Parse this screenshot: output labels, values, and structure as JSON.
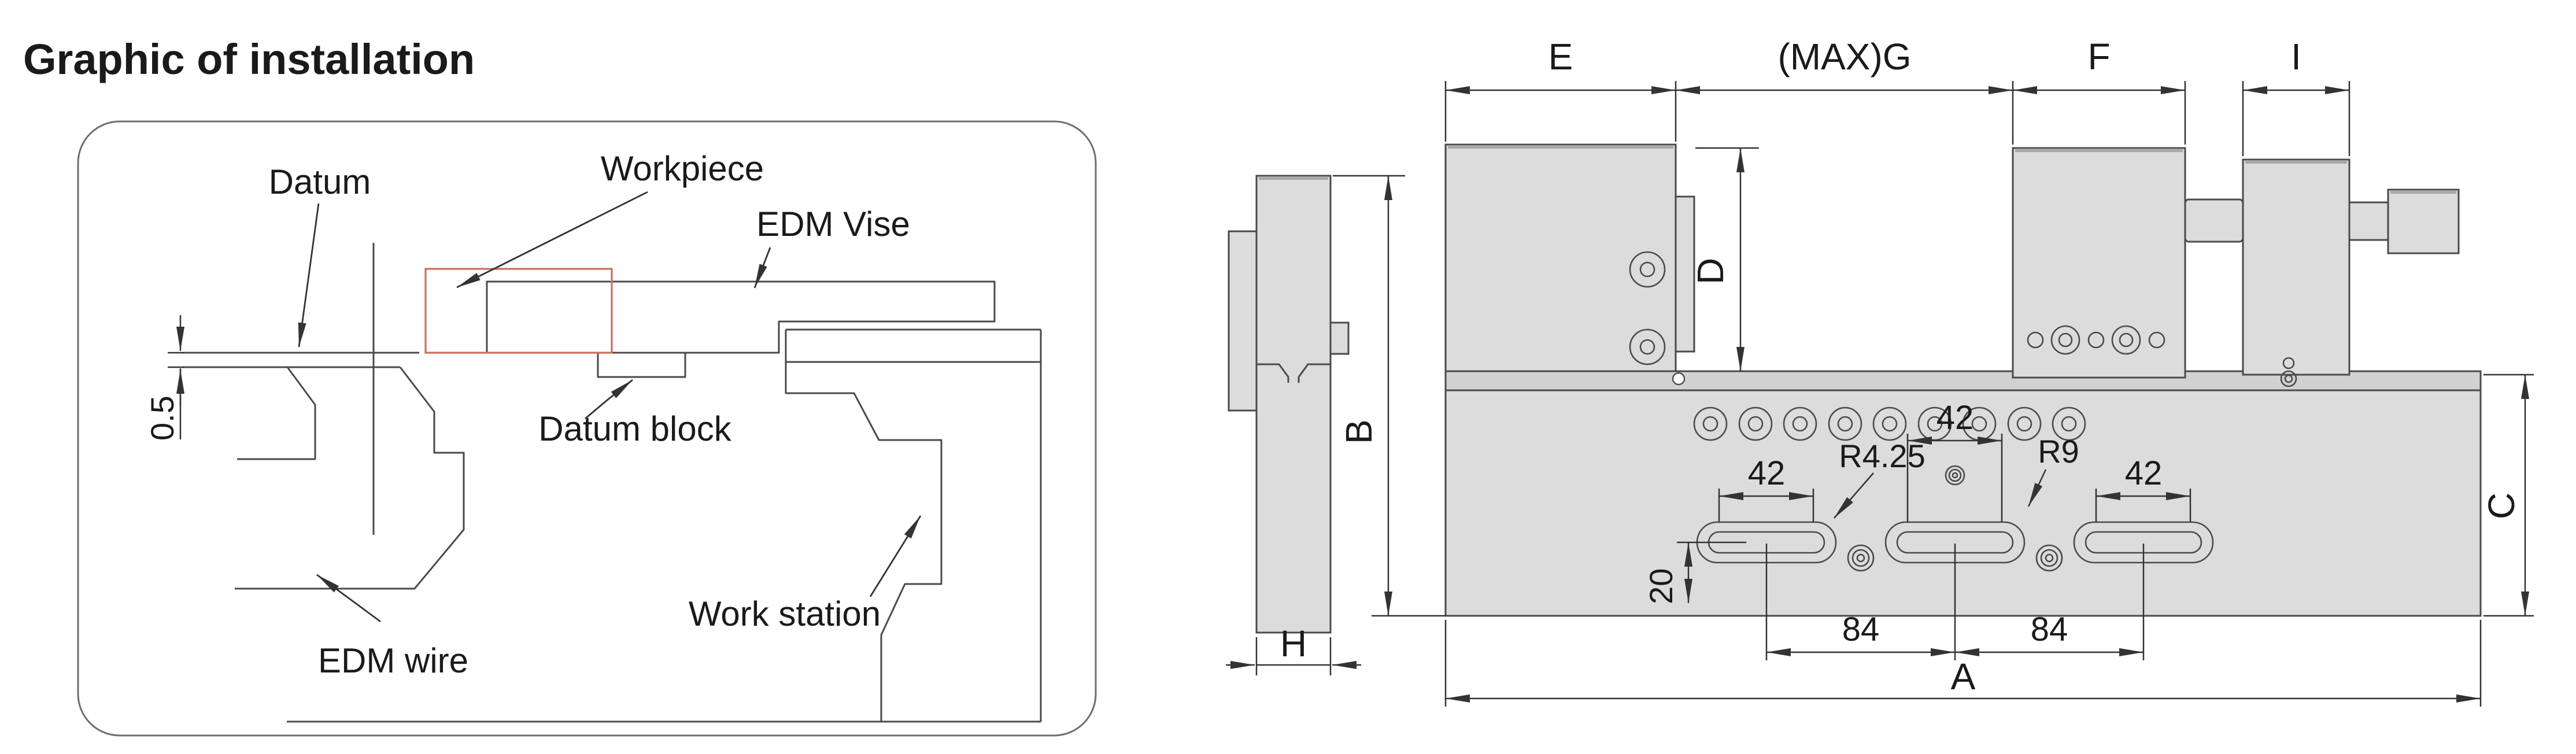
{
  "title": "Graphic of installation",
  "installation_diagram": {
    "labels": {
      "datum": "Datum",
      "workpiece": "Workpiece",
      "edm_vise": "EDM Vise",
      "datum_block": "Datum block",
      "edm_wire": "EDM wire",
      "work_station": "Work station"
    },
    "dimensions": {
      "datum_offset": "0.5"
    }
  },
  "technical_drawing": {
    "dimension_labels": {
      "overall_width": "A",
      "overall_height": "B",
      "base_height": "C",
      "jaw_height": "D",
      "fixed_jaw_width": "E",
      "max_opening": "(MAX)G",
      "movable_jaw_width": "F",
      "clamp_block_width": "I",
      "side_thickness": "H"
    },
    "measurements": {
      "slot_length": "42",
      "slot_spacing": "84",
      "slot_inner_radius": "R4.25",
      "slot_outer_radius": "R9",
      "slot_edge_offset": "20"
    }
  },
  "colors": {
    "part_fill": "#dcdcdc",
    "rail_fill": "#d2d2d2",
    "outline": "#4a4a4a",
    "dimension_line": "#333333",
    "workpiece_outline": "#cc6e62",
    "text": "#1a1a1a"
  }
}
